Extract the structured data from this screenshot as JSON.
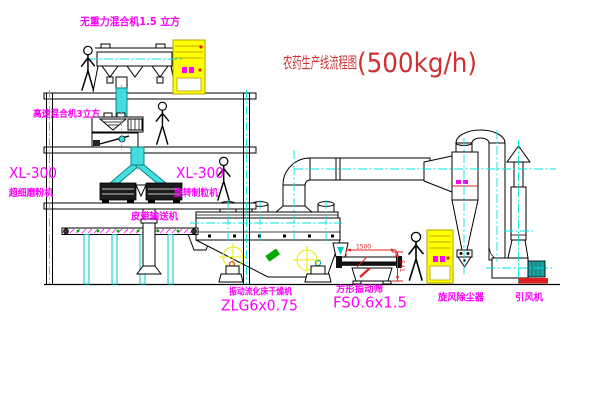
{
  "title": {
    "name": "农药生产线流程图",
    "capacity": "(500kg/h)"
  },
  "labels": {
    "gravity_mixer": "无重力混合机1.5 立方",
    "high_speed_mixer": "高速混合机3立方",
    "mill_model": "XL-300",
    "mill_name": "超细磨粉机",
    "granulator_model": "XL-300",
    "granulator_name": "旋转制粒机",
    "belt_conveyor": "皮带输送机",
    "dryer_name": "振动流化床干燥机",
    "dryer_model": "ZLG6x0.75",
    "sieve_name": "方形振动筛",
    "sieve_model": "FS0.6x1.5",
    "cyclone_name": "旋风除尘器",
    "fan_name": "引风机"
  },
  "dimensions": {
    "sieve_length": "1500",
    "sieve_height": "541"
  },
  "colors": {
    "label_magenta": "#ff00ff",
    "title_red": "#d03030",
    "centerline_cyan": "#00e5e5",
    "cabinet_yellow": "#ffff00",
    "dimension_red": "#e02020",
    "pipe_cyan": "#45dede",
    "motor_teal": "#1f9f9f",
    "base_red": "#dd2020",
    "dot_green": "#00aa00"
  }
}
